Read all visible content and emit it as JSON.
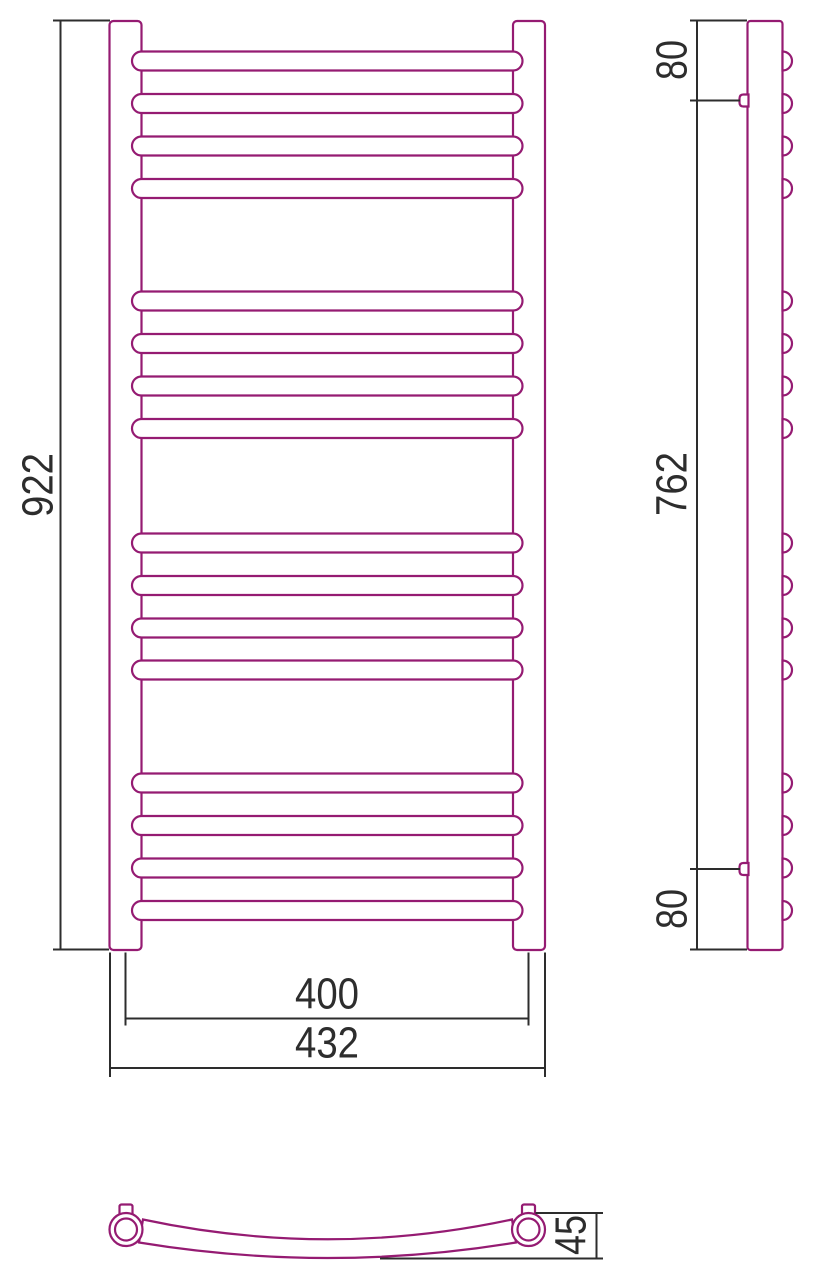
{
  "drawing": {
    "type": "technical-drawing",
    "subject": "ladder heated towel rail - three orthographic views with dimensions",
    "colors": {
      "product": "#951b72",
      "dimension": "#2d2d2d",
      "background": "#ffffff"
    },
    "front_view": {
      "dim_height": "922",
      "dim_width_centers": "400",
      "dim_width_overall": "432",
      "rung_count": 16
    },
    "side_view": {
      "dim_top_bracket_offset": "80",
      "dim_bracket_span": "762",
      "dim_bottom_bracket_offset": "80"
    },
    "plan_view": {
      "dim_depth": "45"
    },
    "geometry": {
      "rung_centers_y": [
        61,
        103.5,
        146,
        188.5,
        301,
        343.5,
        386,
        428.5,
        543,
        585.5,
        628,
        670,
        783,
        825.5,
        868,
        910.5
      ]
    }
  }
}
